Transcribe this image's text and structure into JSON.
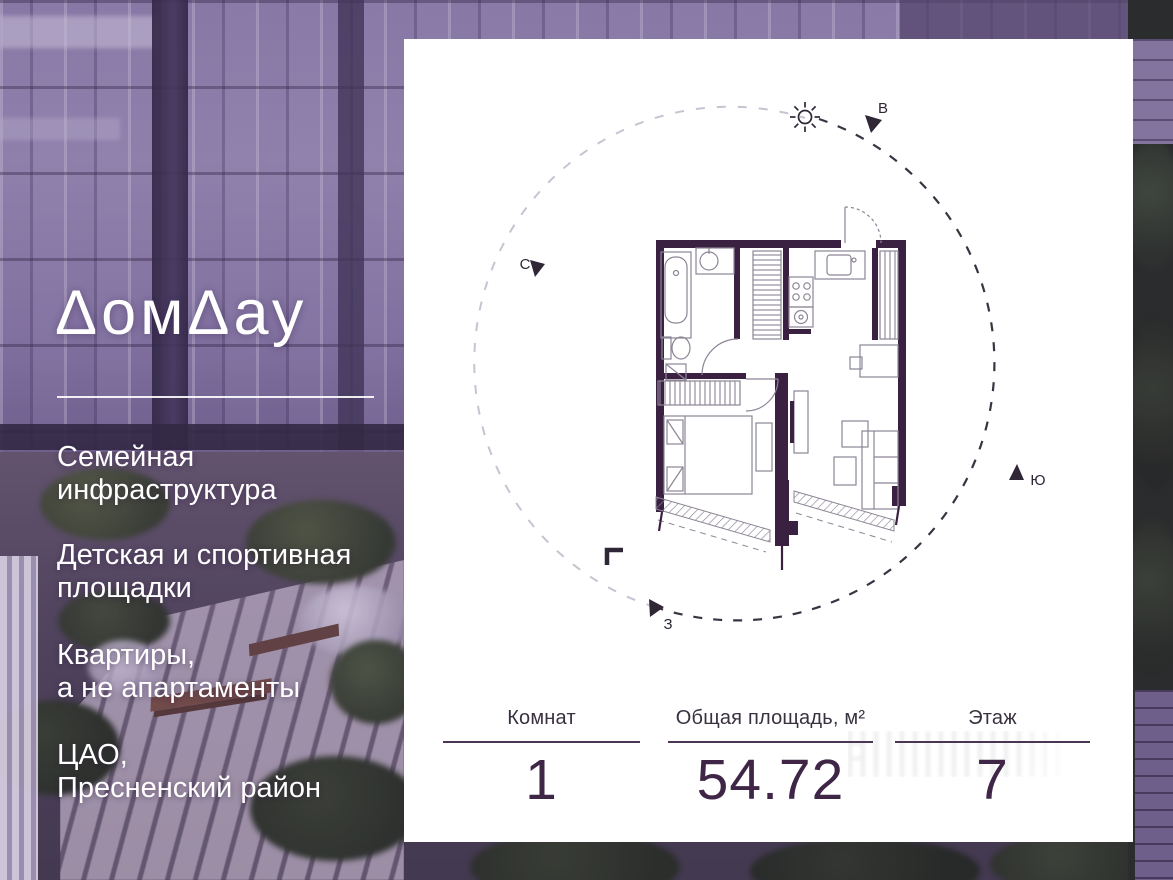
{
  "brand": {
    "name": "ДомДау",
    "display": "ΔомΔау"
  },
  "features": [
    {
      "line1": "Семейная",
      "line2": "инфраструктура"
    },
    {
      "line1": "Детская и спортивная",
      "line2": "площадки"
    },
    {
      "line1": "Квартиры,",
      "line2": "а не апартаменты"
    },
    {
      "line1": "ЦАО,",
      "line2": "Пресненский район"
    }
  ],
  "plan": {
    "type": "apartment floor plan, 1-room",
    "compass": {
      "north": "С",
      "east": "В",
      "south": "Ю",
      "west": "З"
    }
  },
  "stats": {
    "columns": [
      {
        "label": "Комнат",
        "value": "1"
      },
      {
        "label": "Общая площадь, м²",
        "value": "54.72"
      },
      {
        "label": "Этаж",
        "value": "7"
      }
    ]
  },
  "colors": {
    "wall": "#3a2142",
    "plan_lines": "#8d8596",
    "accent_text": "#3f2647",
    "card_bg": "#ffffff",
    "photo_tint": "#7a68a0"
  }
}
